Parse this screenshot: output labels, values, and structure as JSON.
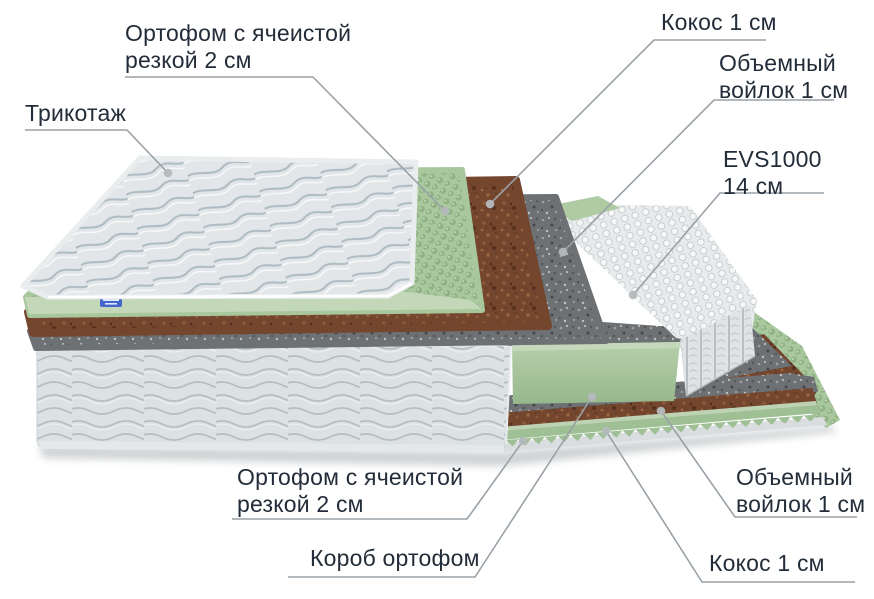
{
  "diagram": {
    "subject": "mattress-layers-cutaway",
    "labels": {
      "ortofom_top": {
        "line1": "Ортофом с ячеистой",
        "line2": "резкой 2 см"
      },
      "trikotazh": {
        "line1": "Трикотаж"
      },
      "kokos_top": {
        "line1": "Кокос 1 см"
      },
      "voilok_top": {
        "line1": "Объемный",
        "line2": "войлок 1 см"
      },
      "evs": {
        "line1": "EVS1000",
        "line2": "14 см"
      },
      "ortofom_bottom": {
        "line1": "Ортофом с ячеистой",
        "line2": "резкой 2 см"
      },
      "korob": {
        "line1": "Короб ортофом"
      },
      "voilok_bottom": {
        "line1": "Объемный",
        "line2": "войлок 1 см"
      },
      "kokos_bottom": {
        "line1": "Кокос 1 см"
      }
    },
    "layers_top_to_bottom": [
      "Трикотаж",
      "Ортофом с ячеистой резкой 2 см",
      "Кокос 1 см",
      "Объемный войлок 1 см",
      "EVS1000 14 см",
      "Объемный войлок 1 см",
      "Кокос 1 см",
      "Короб ортофом",
      "Ортофом с ячеистой резкой 2 см"
    ],
    "colors": {
      "label_text": "#232d39",
      "leader_line": "#9aa1a6",
      "leader_dot": "#b4babd",
      "foam_green": "#a8c79c",
      "foam_green_front": "#c5d9ba",
      "block_green_light": "#c5d8bb",
      "coconut_brown": "#74462e",
      "felt_gray": "#6d7174",
      "spring_white": "#eef0f1",
      "box_fabric": "#dce1e3",
      "zigzag_green": "#9fbf95",
      "strip_green_light": "#bed3b4",
      "tag_blue": "#4466cb"
    }
  }
}
